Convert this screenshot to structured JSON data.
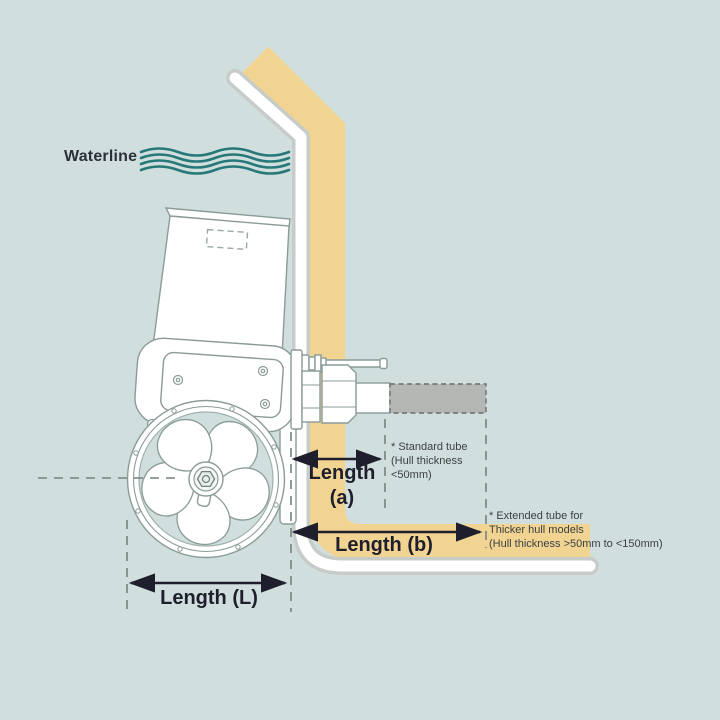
{
  "colors": {
    "background": "#d0dfdd",
    "hull_fill": "#f2d492",
    "casing": "#c7ccc9",
    "stripe": "#ffffff",
    "wave": "#277878",
    "machine_outline": "#8a9b98",
    "tube_fill": "#b4b7b4",
    "tube_dash": "#6b6f6d",
    "guide_dash": "#76827f",
    "dimension": "#1e1e2c",
    "text": "#2c3038",
    "note_text": "#3c4043"
  },
  "waterline": {
    "label": "Waterline"
  },
  "dimensions": {
    "a": {
      "line1": "Length",
      "line2": "(a)"
    },
    "b": {
      "label": "Length (b)"
    },
    "l": {
      "label": "Length (L)"
    }
  },
  "annotations": {
    "standard_tube": {
      "line1": "* Standard tube",
      "line2": "(Hull thickness",
      "line3": "<50mm)"
    },
    "extended_tube": {
      "line1": "* Extended tube for",
      "line2": "Thicker hull models",
      "line3": "(Hull thickness >50mm to <150mm)"
    }
  }
}
